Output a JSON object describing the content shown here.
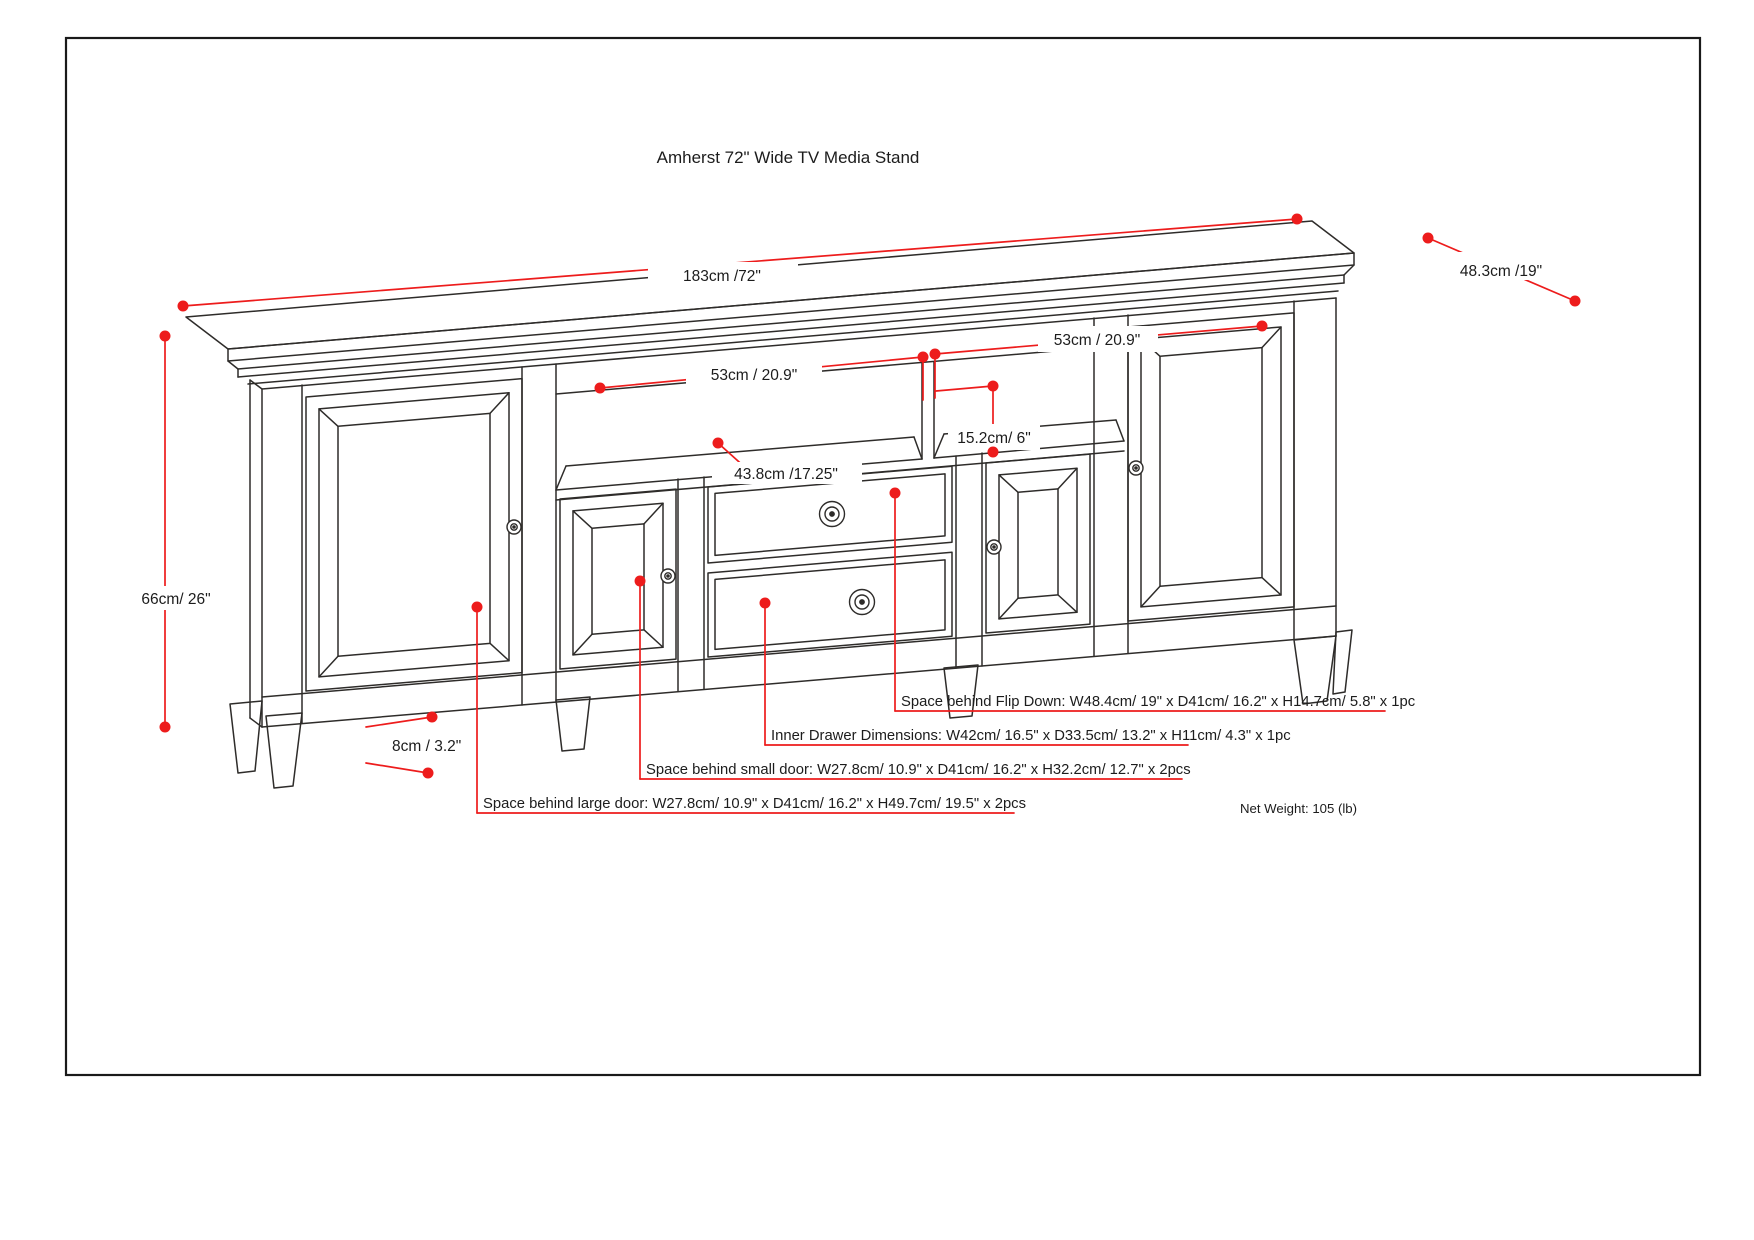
{
  "title": "Amherst 72\" Wide TV Media Stand",
  "diagram": {
    "dimensions": {
      "overall_width": "183cm /72\"",
      "overall_depth": "48.3cm /19\"",
      "overall_height": "66cm/ 26\"",
      "shelf_left_width": "53cm / 20.9\"",
      "shelf_right_width": "53cm / 20.9\"",
      "shelf_opening_height": "15.2cm/ 6\"",
      "shelf_depth": "43.8cm /17.25\"",
      "leg_clearance": "8cm / 3.2\""
    },
    "annotations": {
      "flip_down": "Space behind Flip Down: W48.4cm/ 19\" x D41cm/ 16.2\" x H14.7cm/ 5.8\" x 1pc",
      "inner_drawer": "Inner Drawer Dimensions: W42cm/ 16.5\" x D33.5cm/ 13.2\" x H11cm/ 4.3\" x 1pc",
      "small_door": "Space behind small door: W27.8cm/ 10.9\" x D41cm/ 16.2\" x H32.2cm/ 12.7\" x 2pcs",
      "large_door": "Space behind large door: W27.8cm/ 10.9\" x D41cm/ 16.2\" x H49.7cm/ 19.5\" x 2pcs"
    },
    "net_weight": "Net Weight: 105 (lb)",
    "colors": {
      "dimension_red": "#ed1c1c",
      "line_black": "#2e2c2a"
    }
  }
}
